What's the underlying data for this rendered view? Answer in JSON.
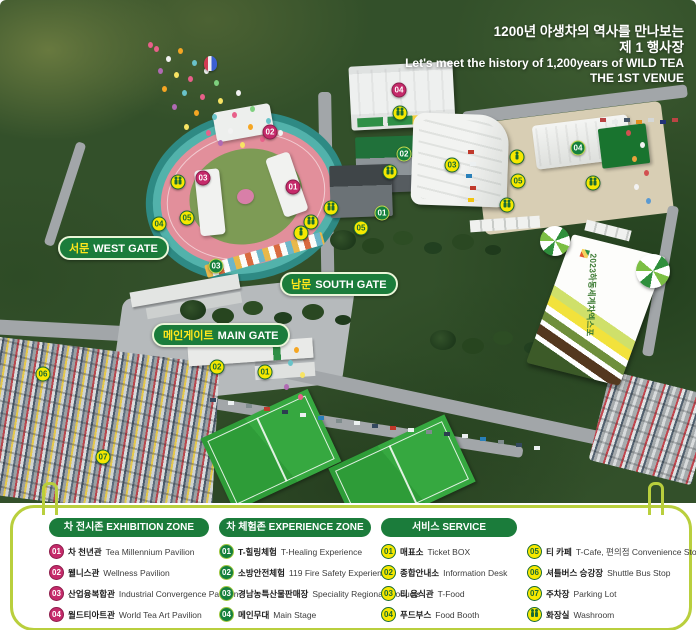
{
  "colors": {
    "exhibition_marker": "#c52a6a",
    "experience_marker": "#15803d",
    "service_marker_fill": "#f6e800",
    "service_marker_text": "#1a6b33",
    "header_pill_green": "#1b7c3b",
    "panel_border": "#b9cf3d",
    "gate_korean_text": "#ffe71c"
  },
  "map": {
    "title": {
      "ko1": "1200년 야생차의 역사를 만나보는",
      "ko2": "제 1 행사장",
      "en1": "Let's meet the history of 1,200years of WILD TEA",
      "en2": "THE 1ST VENUE"
    },
    "banner": {
      "text": "2023하동세계차엑스포"
    },
    "gates": [
      {
        "id": "west",
        "ko": "서문",
        "en": "WEST GATE"
      },
      {
        "id": "south",
        "ko": "남문",
        "en": "SOUTH GATE"
      },
      {
        "id": "main",
        "ko": "메인게이트",
        "en": "MAIN GATE"
      }
    ],
    "markers": [
      {
        "type": "exhibition",
        "label": "01",
        "x": 293,
        "y": 187
      },
      {
        "type": "exhibition",
        "label": "02",
        "x": 270,
        "y": 132
      },
      {
        "type": "exhibition",
        "label": "03",
        "x": 203,
        "y": 178
      },
      {
        "type": "exhibition",
        "label": "04",
        "x": 399,
        "y": 90
      },
      {
        "type": "experience",
        "label": "01",
        "x": 382,
        "y": 213
      },
      {
        "type": "experience",
        "label": "02",
        "x": 404,
        "y": 154
      },
      {
        "type": "experience",
        "label": "03",
        "x": 216,
        "y": 266
      },
      {
        "type": "experience",
        "label": "04",
        "x": 578,
        "y": 148
      },
      {
        "type": "service",
        "label": "01",
        "x": 265,
        "y": 372
      },
      {
        "type": "service",
        "label": "02",
        "x": 217,
        "y": 367
      },
      {
        "type": "service",
        "label": "03",
        "x": 452,
        "y": 165
      },
      {
        "type": "service",
        "label": "04",
        "x": 159,
        "y": 224
      },
      {
        "type": "service",
        "label": "05",
        "x": 187,
        "y": 218
      },
      {
        "type": "service",
        "label": "05",
        "x": 361,
        "y": 228
      },
      {
        "type": "service",
        "label": "05",
        "x": 518,
        "y": 181
      },
      {
        "type": "service",
        "label": "06",
        "x": 43,
        "y": 374
      },
      {
        "type": "service",
        "label": "07",
        "x": 103,
        "y": 457
      },
      {
        "type": "washroom",
        "x": 178,
        "y": 182
      },
      {
        "type": "washroom",
        "x": 400,
        "y": 113
      },
      {
        "type": "washroom",
        "x": 390,
        "y": 172
      },
      {
        "type": "washroom",
        "x": 331,
        "y": 208
      },
      {
        "type": "washroom",
        "x": 311,
        "y": 222
      },
      {
        "type": "washroom",
        "x": 593,
        "y": 183
      },
      {
        "type": "washroom",
        "x": 507,
        "y": 205
      },
      {
        "type": "figure",
        "x": 301,
        "y": 233
      },
      {
        "type": "figure",
        "x": 517,
        "y": 157
      }
    ]
  },
  "legend": {
    "sections": [
      {
        "id": "exhibition",
        "title": "차 전시존 EXHIBITION ZONE",
        "marker_style": "exhibition",
        "items": [
          {
            "num": "01",
            "ko": "차 천년관",
            "en": "Tea Millennium Pavilion"
          },
          {
            "num": "02",
            "ko": "웰니스관",
            "en": "Wellness Pavilion"
          },
          {
            "num": "03",
            "ko": "산업융복합관",
            "en": "Industrial Convergence Pavilion"
          },
          {
            "num": "04",
            "ko": "월드티아트관",
            "en": "World Tea Art Pavilion"
          }
        ]
      },
      {
        "id": "experience",
        "title": "차 체험존 EXPERIENCE ZONE",
        "marker_style": "experience",
        "items": [
          {
            "num": "01",
            "ko": "T-힐링체험",
            "en": "T-Healing Experience"
          },
          {
            "num": "02",
            "ko": "소방안전체험",
            "en": "119 Fire Safety Experience"
          },
          {
            "num": "03",
            "ko": "경남농특산물판매장",
            "en": "Speciality Regional Products"
          },
          {
            "num": "04",
            "ko": "메인무대",
            "en": "Main Stage"
          }
        ]
      },
      {
        "id": "service",
        "title": "서비스 SERVICE",
        "marker_style": "service",
        "items": [
          {
            "num": "01",
            "ko": "매표소",
            "en": "Ticket BOX"
          },
          {
            "num": "02",
            "ko": "종합안내소",
            "en": "Information Desk"
          },
          {
            "num": "03",
            "ko": "티 음식관",
            "en": "T-Food"
          },
          {
            "num": "04",
            "ko": "푸드부스",
            "en": "Food Booth"
          }
        ]
      },
      {
        "id": "service-2",
        "title": null,
        "marker_style": "service",
        "items": [
          {
            "num": "05",
            "ko": "티 카페",
            "en": "T-Cafe, 편의점 Convenience Store"
          },
          {
            "num": "06",
            "ko": "셔틀버스 승강장",
            "en": "Shuttle Bus Stop"
          },
          {
            "num": "07",
            "ko": "주차장",
            "en": "Parking Lot"
          },
          {
            "num": "WC",
            "icon": "washroom",
            "ko": "화장실",
            "en": "Washroom"
          }
        ]
      }
    ]
  }
}
